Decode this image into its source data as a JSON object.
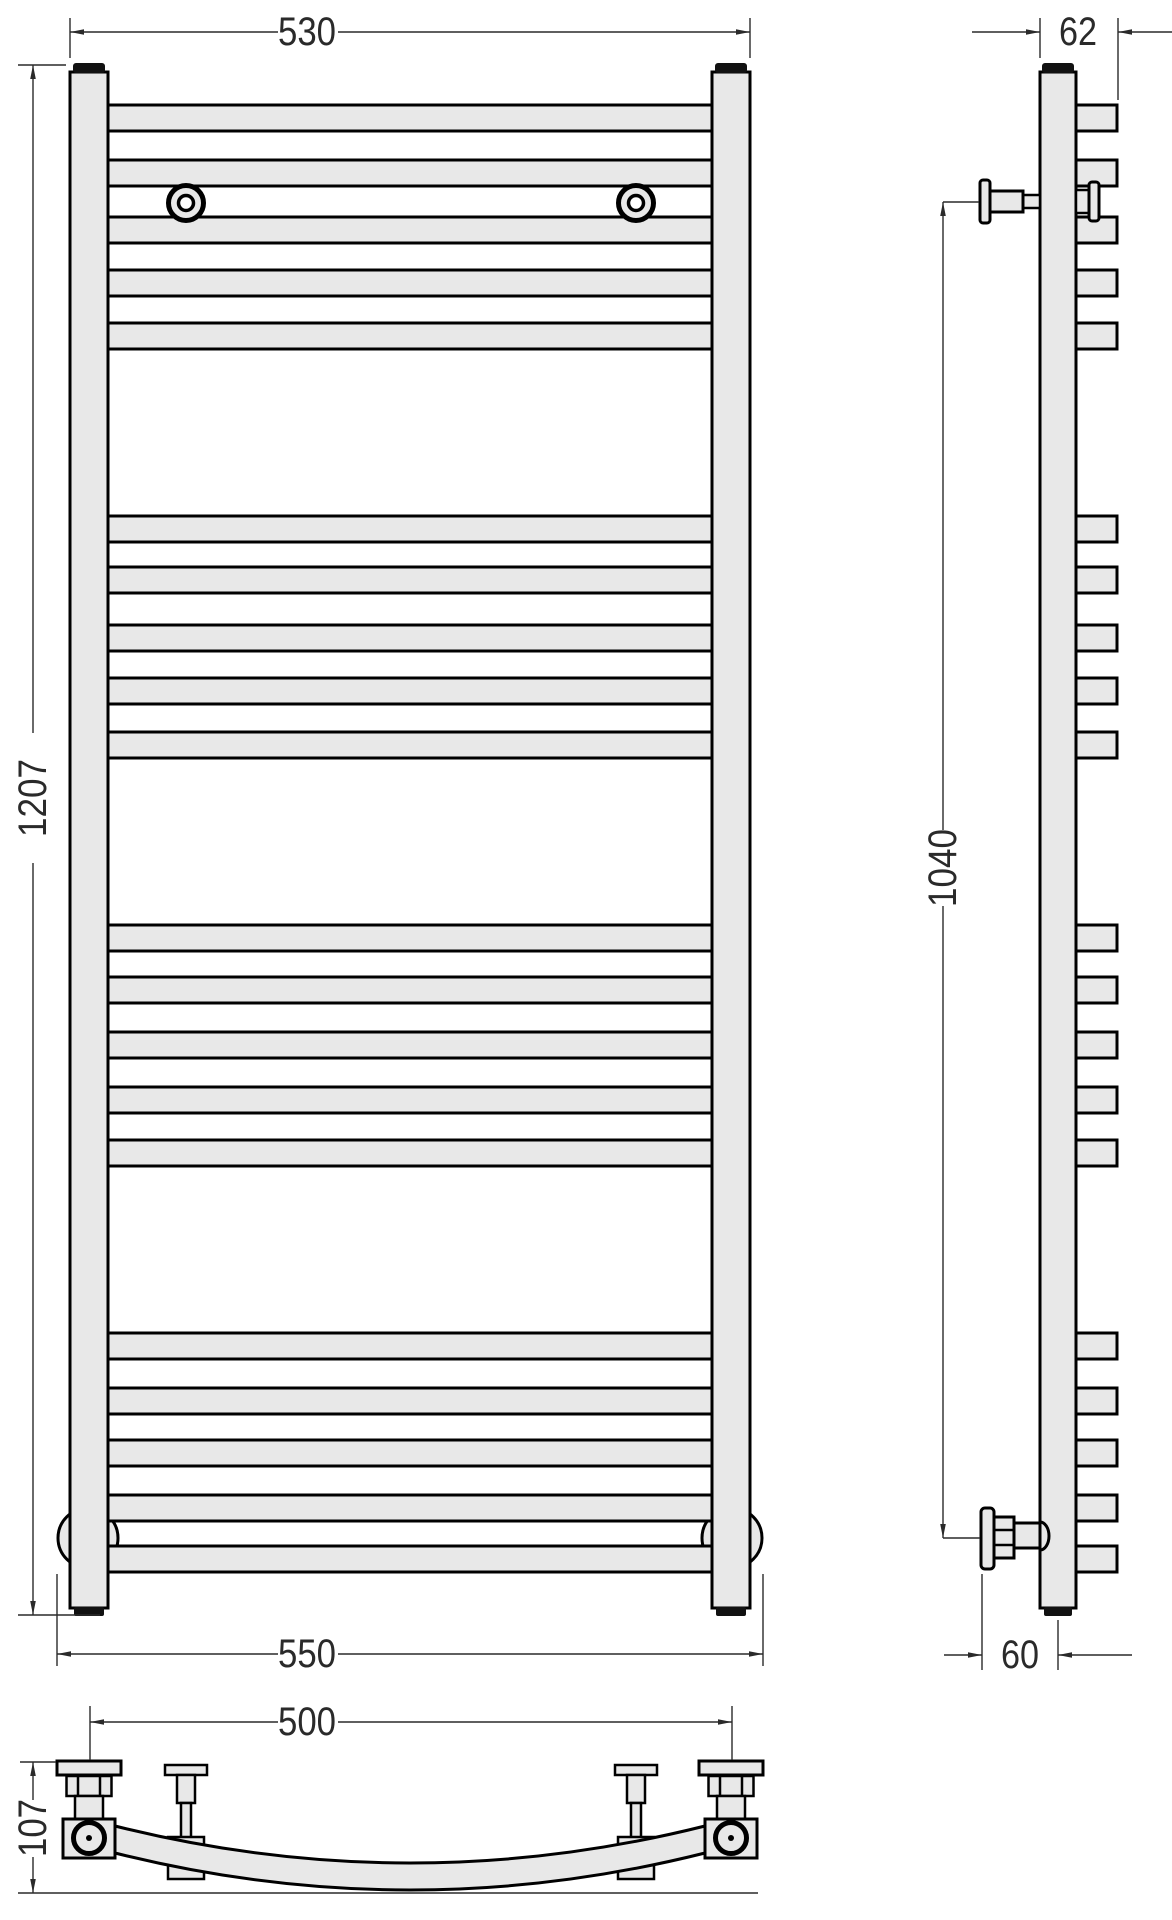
{
  "colors": {
    "background": "#ffffff",
    "part_fill": "#e8e8e8",
    "outline": "#000000",
    "cap": "#111111",
    "dimension": "#2a2a2a"
  },
  "dimensions": {
    "front_outer_width": "530",
    "front_height": "1207",
    "front_overall_width": "550",
    "side_depth": "62",
    "side_connection_span": "1040",
    "side_wall_offset": "60",
    "bottom_connection_span": "500",
    "bottom_depth": "107"
  },
  "structure": {
    "rung_height": 26,
    "rung_groups": [
      [
        105,
        160,
        217,
        270,
        323
      ],
      [
        516,
        567,
        625,
        678,
        732
      ],
      [
        925,
        977,
        1032,
        1087,
        1140
      ],
      [
        1333,
        1388,
        1440,
        1495,
        1546
      ]
    ]
  }
}
